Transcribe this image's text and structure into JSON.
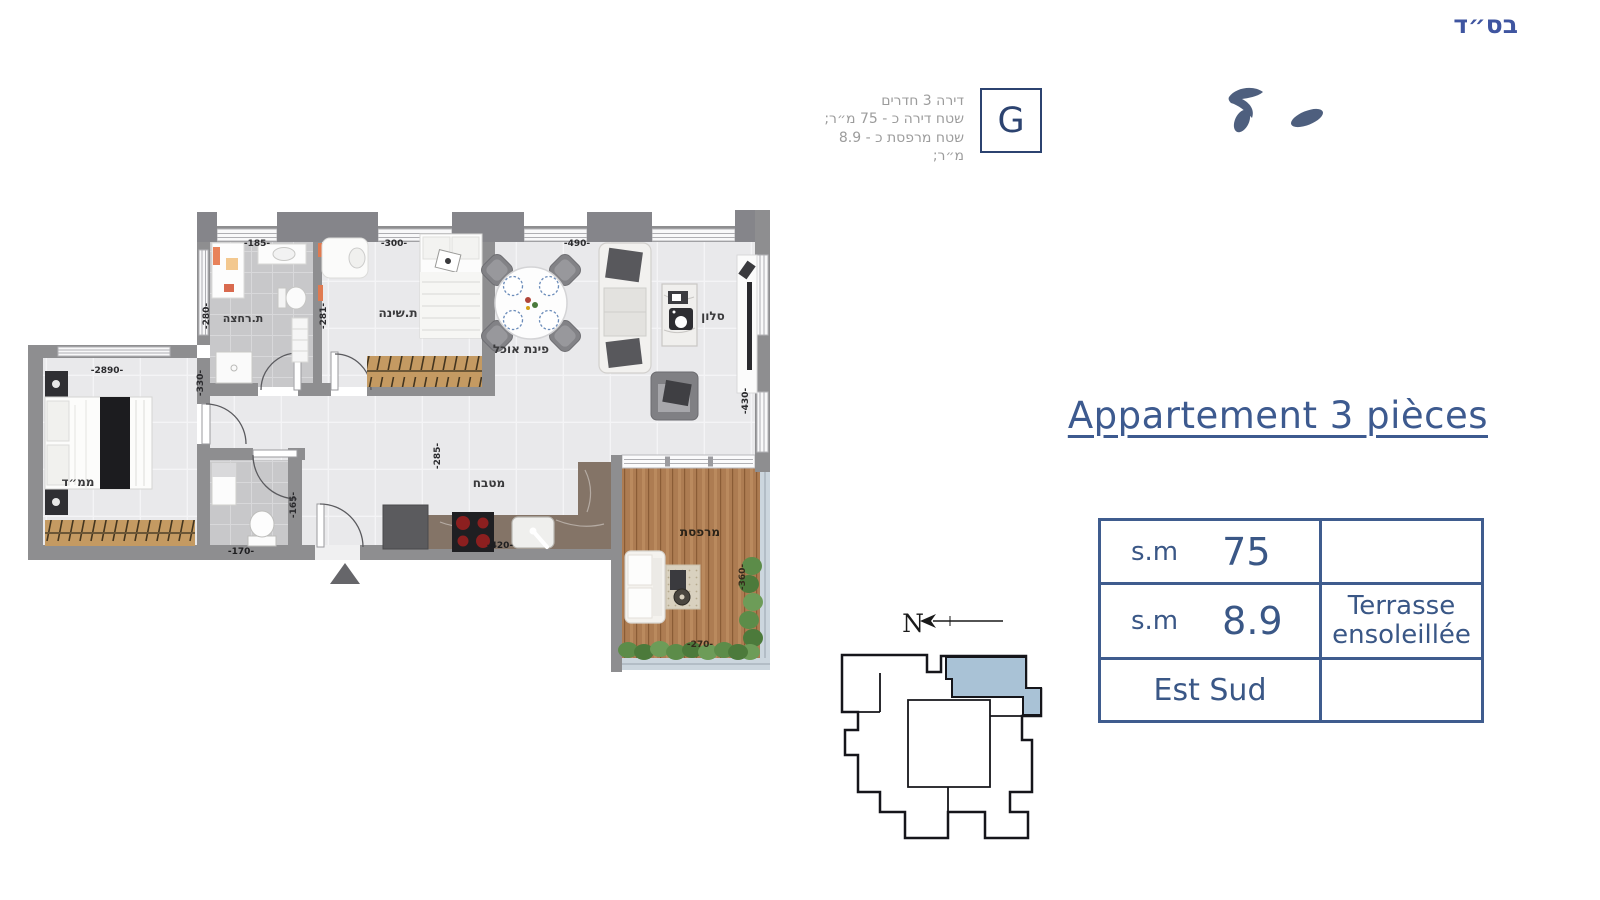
{
  "page": {
    "bsd": "בס״ד"
  },
  "unit_info": {
    "letter": "G",
    "lines": [
      "דירה 3 חדרים",
      "שטח דירה כ - 75 מ״ר;",
      "שטח מרפסת כ - 8.9 מ״ר;"
    ]
  },
  "title": "Appartement 3 pièces",
  "spec_table": {
    "rows": [
      {
        "label": "s.m",
        "value": "75",
        "note_line1": "",
        "note_line2": ""
      },
      {
        "label": "s.m",
        "value": "8.9",
        "note_line1": "Terrasse",
        "note_line2": "ensoleillée"
      },
      {
        "label": "Est Sud",
        "value": "",
        "note_line1": "",
        "note_line2": ""
      }
    ]
  },
  "compass": {
    "letter": "N"
  },
  "floorplan": {
    "rooms": {
      "bathroom": "ת.רחצה",
      "bedroom": "ת.שינה",
      "dining": "פינת אוכל",
      "living": "סלון",
      "mamad": "ממ״ד",
      "kitchen": "מטבח",
      "balcony": "מרפסת"
    },
    "dimensions": {
      "bathroom_width": "-185-",
      "bathroom_depth": "-280-",
      "bedroom_width": "-300-",
      "bedroom_depth": "-281-",
      "living_width": "-490-",
      "living_depth": "-430-",
      "mamad_width": "-2890-",
      "mamad_depth": "-330-",
      "hall_depth": "-285-",
      "kitchen_width": "-420-",
      "toilet_width": "-170-",
      "toilet_depth": "-165-",
      "balcony_width": "-270-",
      "balcony_depth": "-360-"
    }
  },
  "colors": {
    "accent_blue": "#3d5a8f",
    "table_border": "#3f5c8e",
    "info_gray": "#9c9c9c",
    "wall_gray": "#8e8e90",
    "key_plan_highlight": "#a9c2d6",
    "wood_deck": "#ad7c52"
  }
}
